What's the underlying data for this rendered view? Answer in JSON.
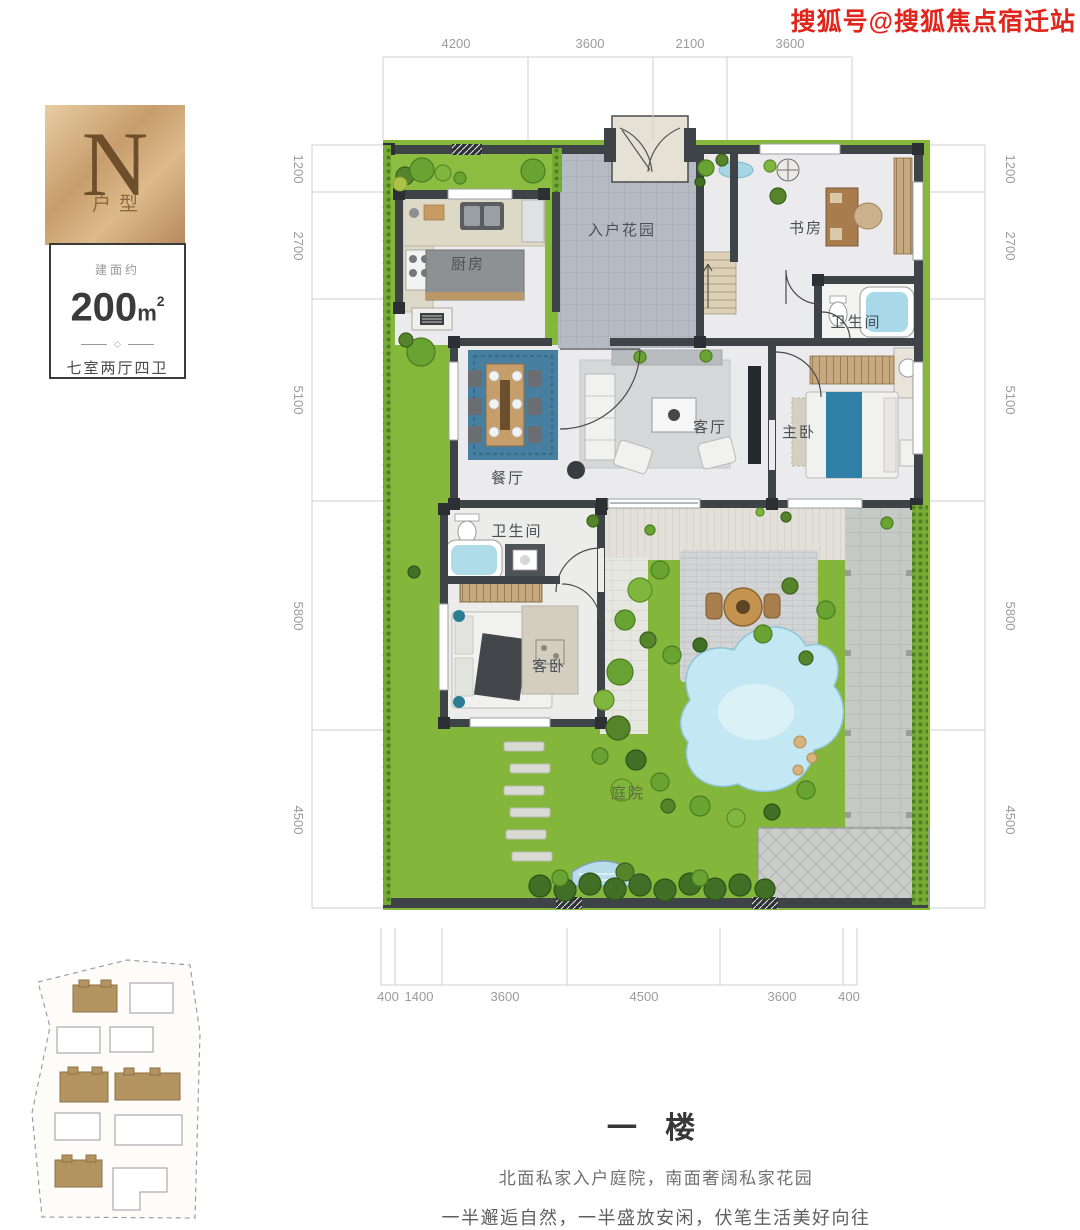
{
  "watermark": {
    "text": "搜狐号@搜狐焦点宿迁站"
  },
  "unit_badge": {
    "letter": "N",
    "suffix": "户型"
  },
  "info_card": {
    "area_label": "建面约",
    "area_value": "200",
    "area_unit": "m",
    "area_exp": "2",
    "divider_glyph": "◇",
    "layout_text": "七室两厅四卫"
  },
  "plan": {
    "dims_top": [
      "4200",
      "3600",
      "2100",
      "3600"
    ],
    "dims_bottom": [
      "400",
      "1400",
      "3600",
      "4500",
      "3600",
      "400"
    ],
    "dims_left": [
      "1200",
      "2700",
      "5100",
      "5800",
      "4500"
    ],
    "dims_right": [
      "1200",
      "2700",
      "5100",
      "5800",
      "4500"
    ],
    "rooms": {
      "kitchen": "厨房",
      "entry_garden": "入户花园",
      "study": "书房",
      "bath_upper": "卫生间",
      "dining": "餐厅",
      "living": "客厅",
      "master": "主卧",
      "bath_lower": "卫生间",
      "guest": "客卧",
      "courtyard": "庭院"
    }
  },
  "footer": {
    "title": "一 楼",
    "line1": "北面私家入户庭院，南面奢阔私家花园",
    "line2": "一半邂逅自然，一半盛放安闲，伏笔生活美好向往"
  },
  "colors": {
    "watermark_red": "#e0261c",
    "badge_gold": "#c79d6c",
    "wall_dark": "#3e4347",
    "lawn_green": "#87b83d",
    "pond_blue": "#c4e8f3",
    "entry_tile": "#b4bbc3",
    "bed_blue": "#2f7fa6",
    "site_brown": "#b3935f"
  }
}
